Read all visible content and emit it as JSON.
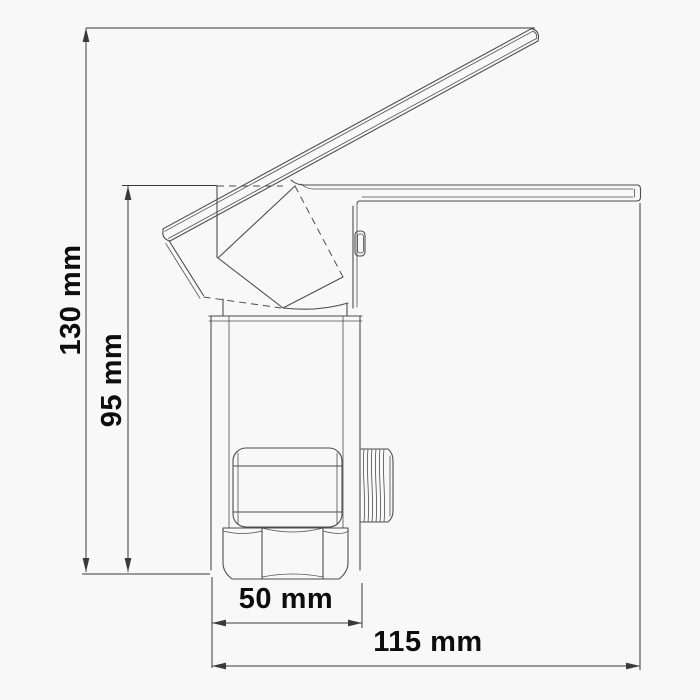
{
  "drawing": {
    "background_color": "#f8f8f8",
    "line_color": "#4d4d4d",
    "dimension_line_color": "#3a3a3a",
    "text_color": "#0d0d0d"
  },
  "dimensions": {
    "overall_height": {
      "label": "130 mm",
      "value": 130,
      "unit": "mm",
      "orientation": "vertical"
    },
    "body_height": {
      "label": "95 mm",
      "value": 95,
      "unit": "mm",
      "orientation": "vertical"
    },
    "base_width": {
      "label": "50 mm",
      "value": 50,
      "unit": "mm",
      "orientation": "horizontal"
    },
    "overall_depth": {
      "label": "115 mm",
      "value": 115,
      "unit": "mm",
      "orientation": "horizontal"
    }
  }
}
